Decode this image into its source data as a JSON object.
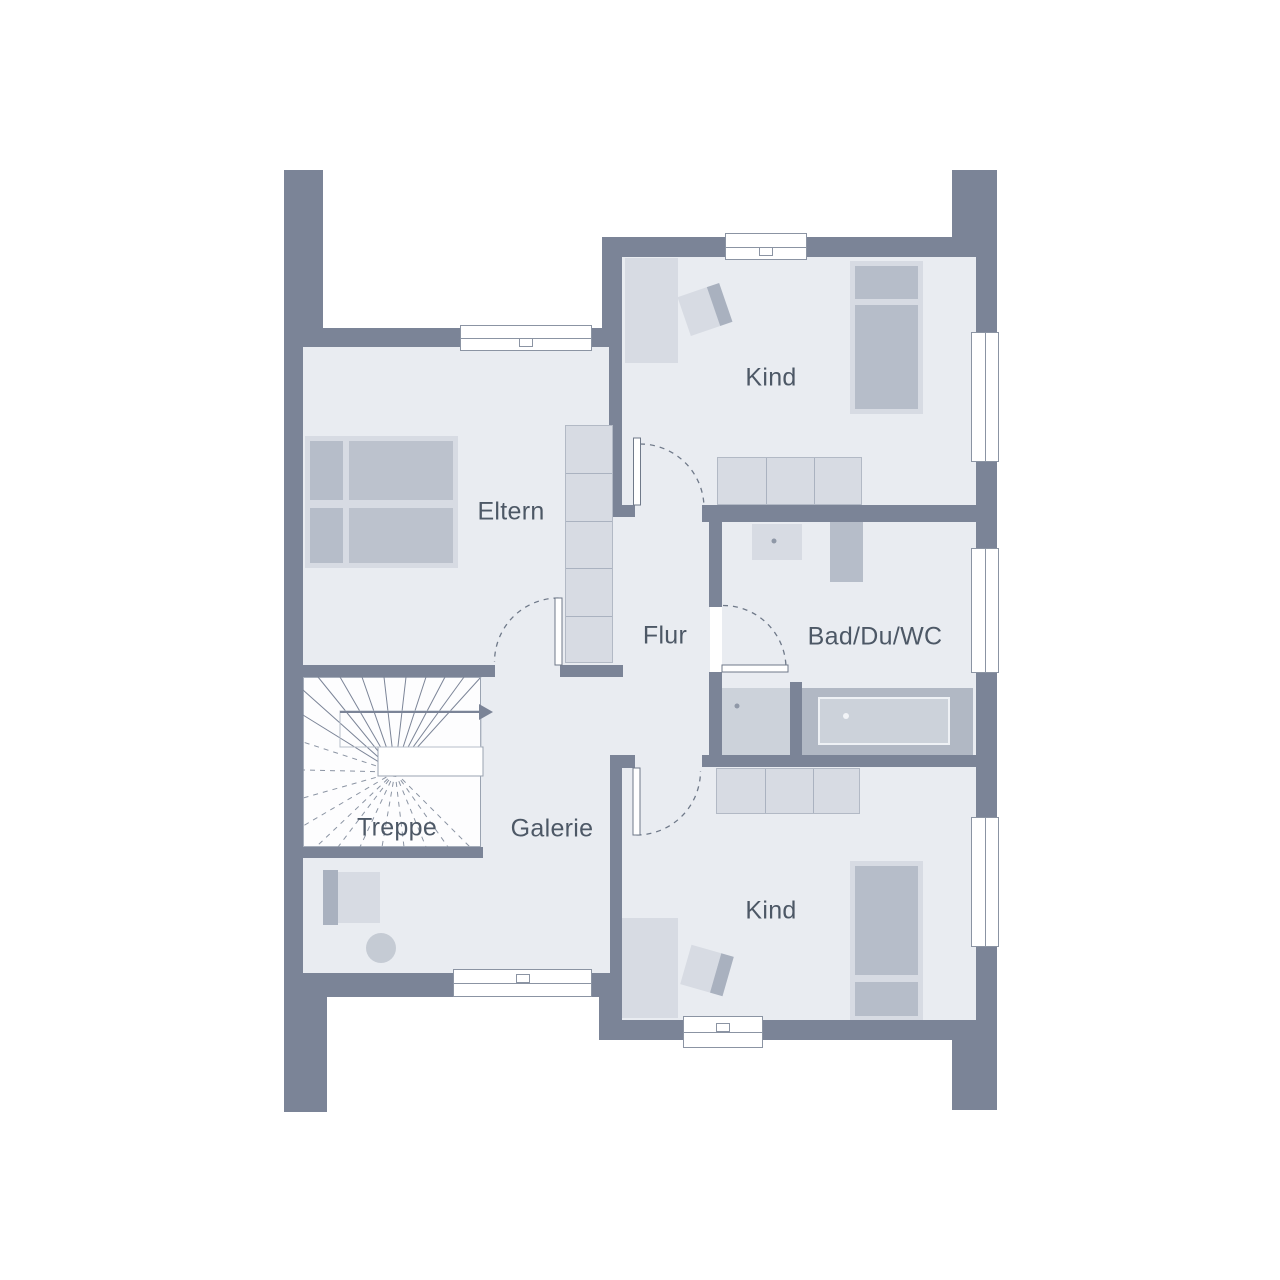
{
  "plan_type": "floor-plan",
  "rooms": [
    {
      "id": "eltern",
      "label": "Eltern"
    },
    {
      "id": "kind-top",
      "label": "Kind"
    },
    {
      "id": "flur",
      "label": "Flur"
    },
    {
      "id": "bad",
      "label": "Bad/Du/WC"
    },
    {
      "id": "treppe",
      "label": "Treppe"
    },
    {
      "id": "galerie",
      "label": "Galerie"
    },
    {
      "id": "kind-bottom",
      "label": "Kind"
    }
  ],
  "colors": {
    "wall": "#7b8497",
    "floor": "#e9ecf1",
    "furniture_light": "#d7dbe3",
    "furniture_mid": "#b6bdc9",
    "furniture_dark": "#a9b1bf",
    "stairwell": "#fdfdfe",
    "outline": "#8b94a3",
    "text": "#4d5866",
    "background": "#ffffff"
  },
  "features": {
    "windows": 7,
    "doors": 4,
    "stair_arrow_direction": "right"
  }
}
